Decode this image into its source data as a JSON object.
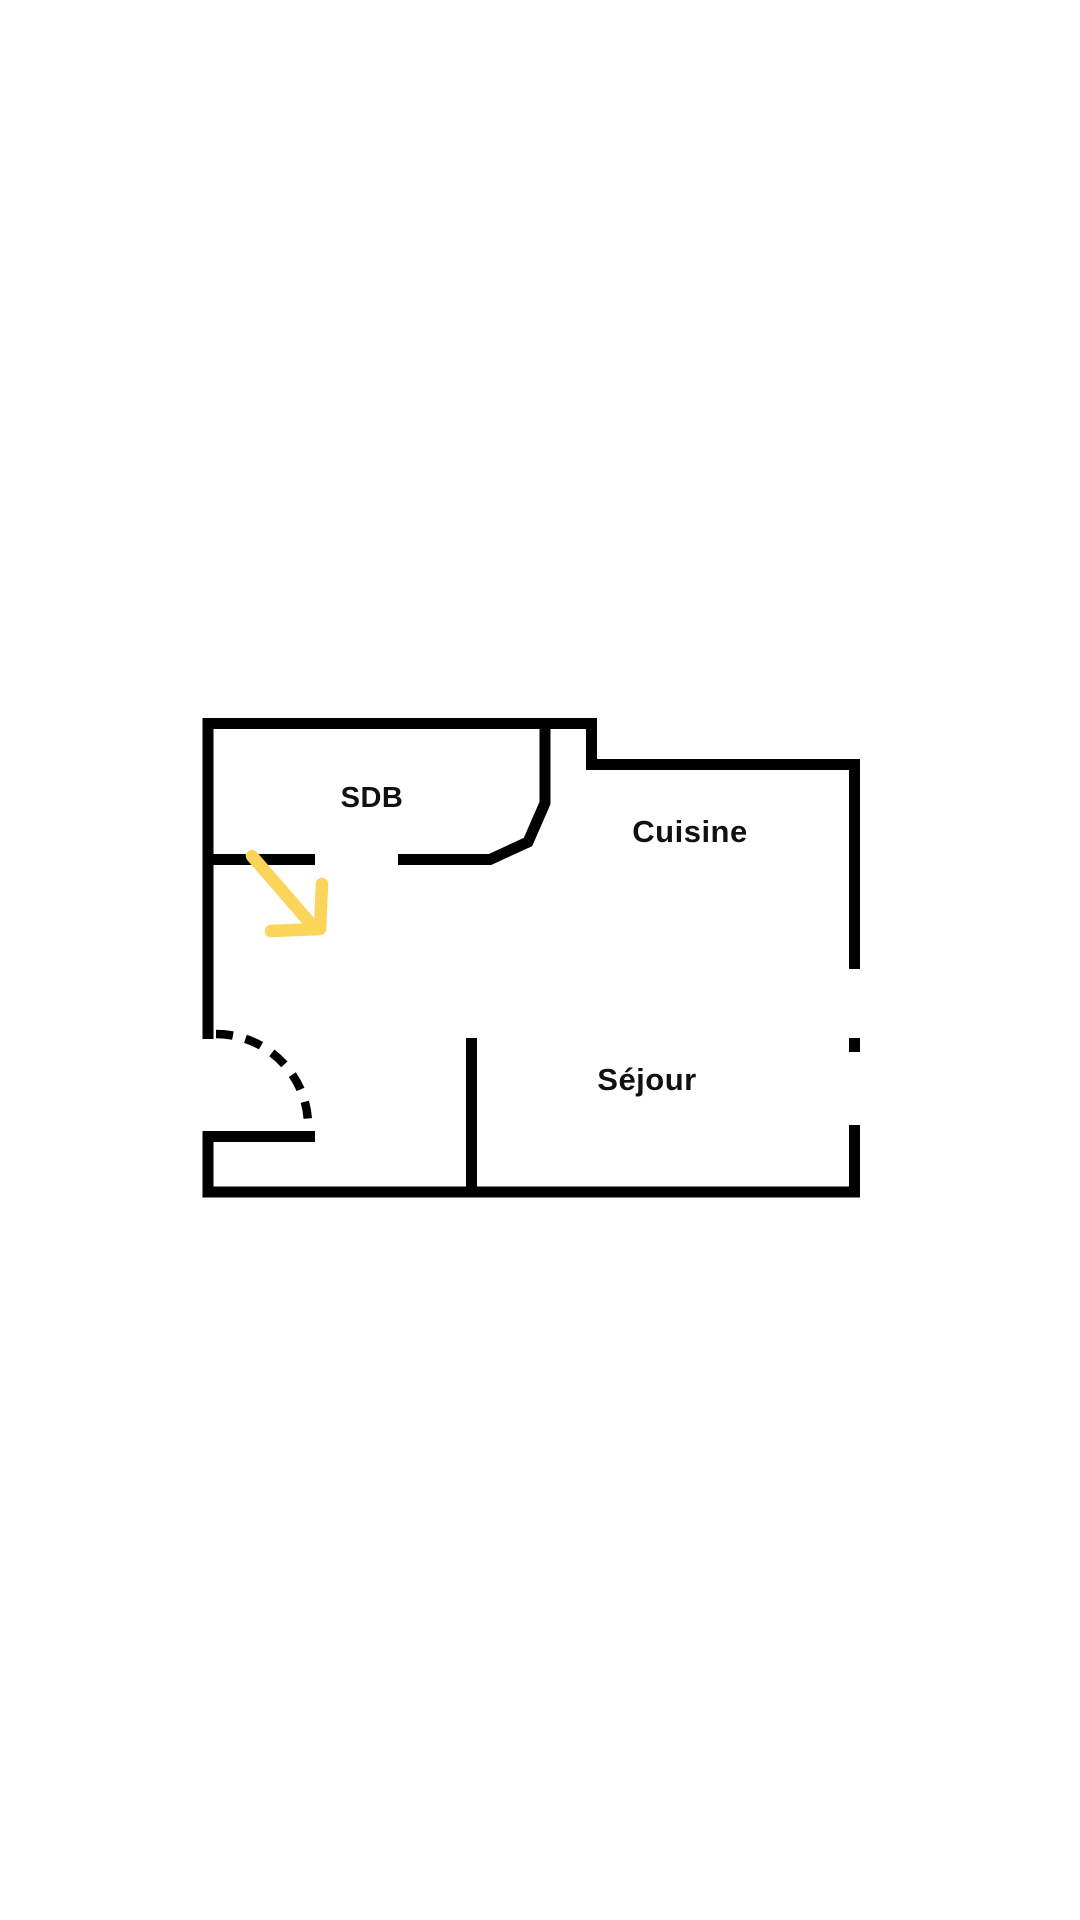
{
  "floor_plan": {
    "rooms": {
      "sdb": {
        "label": "SDB"
      },
      "cuisine": {
        "label": "Cuisine"
      },
      "sejour": {
        "label": "Séjour"
      }
    },
    "features": {
      "entry_door_swing": "dashed quarter-circle arc at bottom-left entrance",
      "right_wall_opening": "window gap with small center dash in right wall",
      "highlight_arrow": "yellow arrow pointing down-right into hallway below SDB"
    },
    "colors": {
      "background": "#ffffff",
      "wall": "#000000",
      "text": "#111111",
      "arrow": "#FAD55A"
    }
  }
}
